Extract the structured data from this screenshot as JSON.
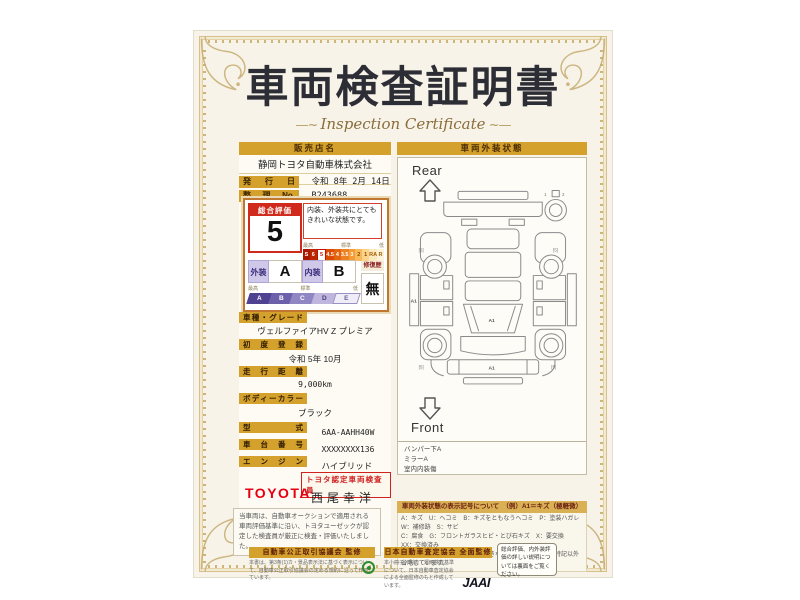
{
  "certificate": {
    "title": "車両検査証明書",
    "subtitle": "Inspection Certificate"
  },
  "colors": {
    "accent_gold": "#d5a12d",
    "rating_red": "#cf2a1b",
    "toyota_red": "#e60012",
    "scale_purple": "#4f4391",
    "page_bg": "#f7f3e8"
  },
  "dealer": {
    "label": "販売店名",
    "name": "静岡トヨタ自動車株式会社",
    "issue_date_label": "発行日",
    "issue_date": "令和 8年 2月 14日",
    "ref_no_label": "整理No.",
    "ref_no": "B243688"
  },
  "rating": {
    "overall_label": "総合評価",
    "overall_value": "5",
    "comment": "内装、外装共にとてもきれいな状態です。",
    "scale_top": {
      "high": "最高",
      "mid": "標準",
      "low": "低",
      "cells": [
        "S",
        "6",
        "5",
        "4.5",
        "4",
        "3.5",
        "3",
        "2",
        "1",
        "RA",
        "R"
      ],
      "selected": "5"
    },
    "exterior_label": "外装",
    "exterior_value": "A",
    "interior_label": "内装",
    "interior_value": "B",
    "repair_label": "修復歴",
    "repair_value": "無",
    "scale_bottom": {
      "high": "最高",
      "mid": "標準",
      "low": "低",
      "cells": [
        "A",
        "B",
        "C",
        "D",
        "E"
      ]
    }
  },
  "fields": [
    {
      "label": "車種・グレード",
      "value": "ヴェルファイアHV Z プレミア"
    },
    {
      "label": "初度登録",
      "value": "令和 5年 10月"
    },
    {
      "label": "走行距離",
      "value": "9,000km"
    },
    {
      "label": "ボディーカラー",
      "value": "ブラック"
    },
    {
      "label": "型式",
      "value": "6AA-AAHH40W"
    },
    {
      "label": "車台番号",
      "value": "XXXXXXXX136"
    },
    {
      "label": "エンジン",
      "value": "ハイブリッド"
    }
  ],
  "inspector": {
    "brand": "TOYOTA",
    "badge": "トヨタ認定車両検査員",
    "name": "西尾幸洋"
  },
  "disclaimer": "当車両は、自動車オークションで適用される車両評価基準に沿い、トヨタユーゼックが認定した検査員が厳正に検査・評価いたしました。",
  "diagram": {
    "header": "車両外装状態",
    "rear_label": "Rear",
    "front_label": "Front",
    "marks": [
      "A1",
      "A1",
      "A1"
    ],
    "wheel_labels": [
      "[6]",
      "[5]",
      "[5]",
      "[5]"
    ],
    "spare_labels": [
      "1",
      "2"
    ],
    "notes": [
      "バンパー下A",
      "ミラーA",
      "室内内装傷"
    ]
  },
  "legend": {
    "header": "車両外装状態の表示記号について　（例）A1＝キズ（極軽微）",
    "lines": [
      "A：キズ　U：ヘコミ　B：キズをともなうヘコミ　P：塗装ハガレ　W：補修跡　S：サビ",
      "C：腐食　G：フロントガラスヒビ・とび石キズ　X：要交換　XX：交換済み",
      "1：小さな　2：中位　3：やや大きな　※軽微な多キズは特記以外省略しています。"
    ]
  },
  "footer": {
    "fair_trade": {
      "header": "自動車公正取引協議会 監修",
      "text": "本書は、第3条(1)カ・景品表示法に基づく表示について、自動車公正取引協議会の定める規約に沿って作成しています。"
    },
    "jaai": {
      "header": "日本自動車査定協会 全面監修",
      "text": "本小冊子・別表・運用検査基準について、日本自動車査定協会による全面監修のもと作成しています。",
      "logo": "JAAI"
    },
    "note": "総合評価、内外装評価の詳しい説明については裏面をご覧ください。"
  }
}
